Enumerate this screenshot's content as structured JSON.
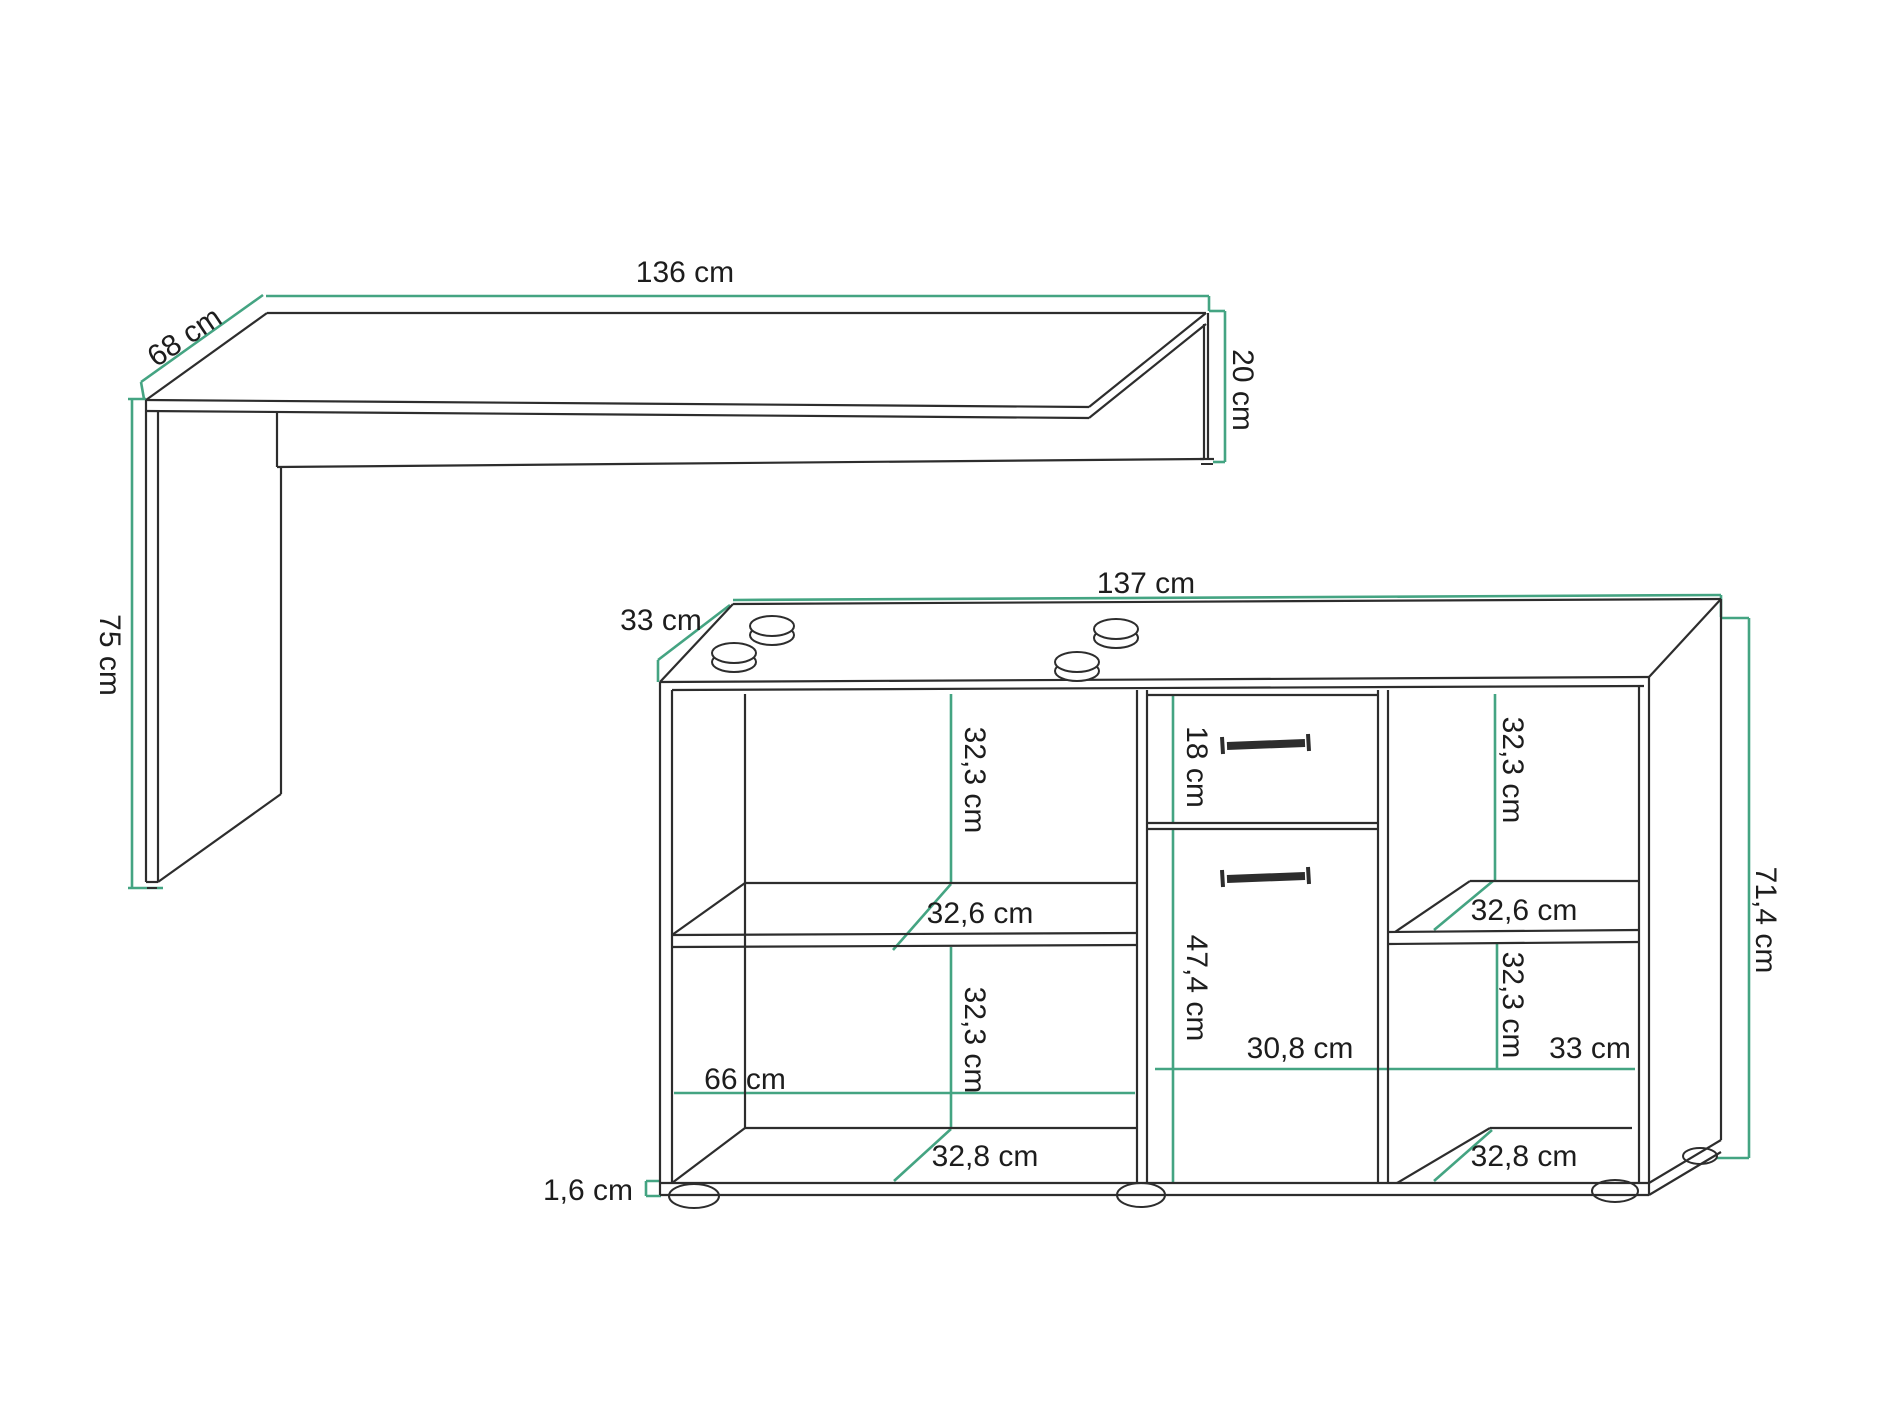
{
  "colors": {
    "background": "#ffffff",
    "line": "#2d2d2d",
    "dimension": "#44a482",
    "text": "#1d1d1d"
  },
  "desk": {
    "width": "136 cm",
    "depth": "68 cm",
    "height": "75 cm",
    "side_panel_height": "20 cm"
  },
  "cabinet": {
    "width": "137 cm",
    "depth": "33 cm",
    "height": "71,4 cm",
    "base_thickness": "1,6 cm",
    "left_section": {
      "top_compartment_height": "32,3 cm",
      "shelf_depth": "32,6 cm",
      "bottom_compartment_height": "32,3 cm",
      "inner_width": "66 cm",
      "floor_depth": "32,8 cm"
    },
    "middle_section": {
      "drawer_height": "18 cm",
      "door_height": "47,4 cm",
      "inner_width": "30,8 cm"
    },
    "right_section": {
      "top_compartment_height": "32,3 cm",
      "shelf_depth": "32,6 cm",
      "bottom_compartment_height": "32,3 cm",
      "inner_width": "33 cm",
      "floor_depth": "32,8 cm"
    }
  }
}
